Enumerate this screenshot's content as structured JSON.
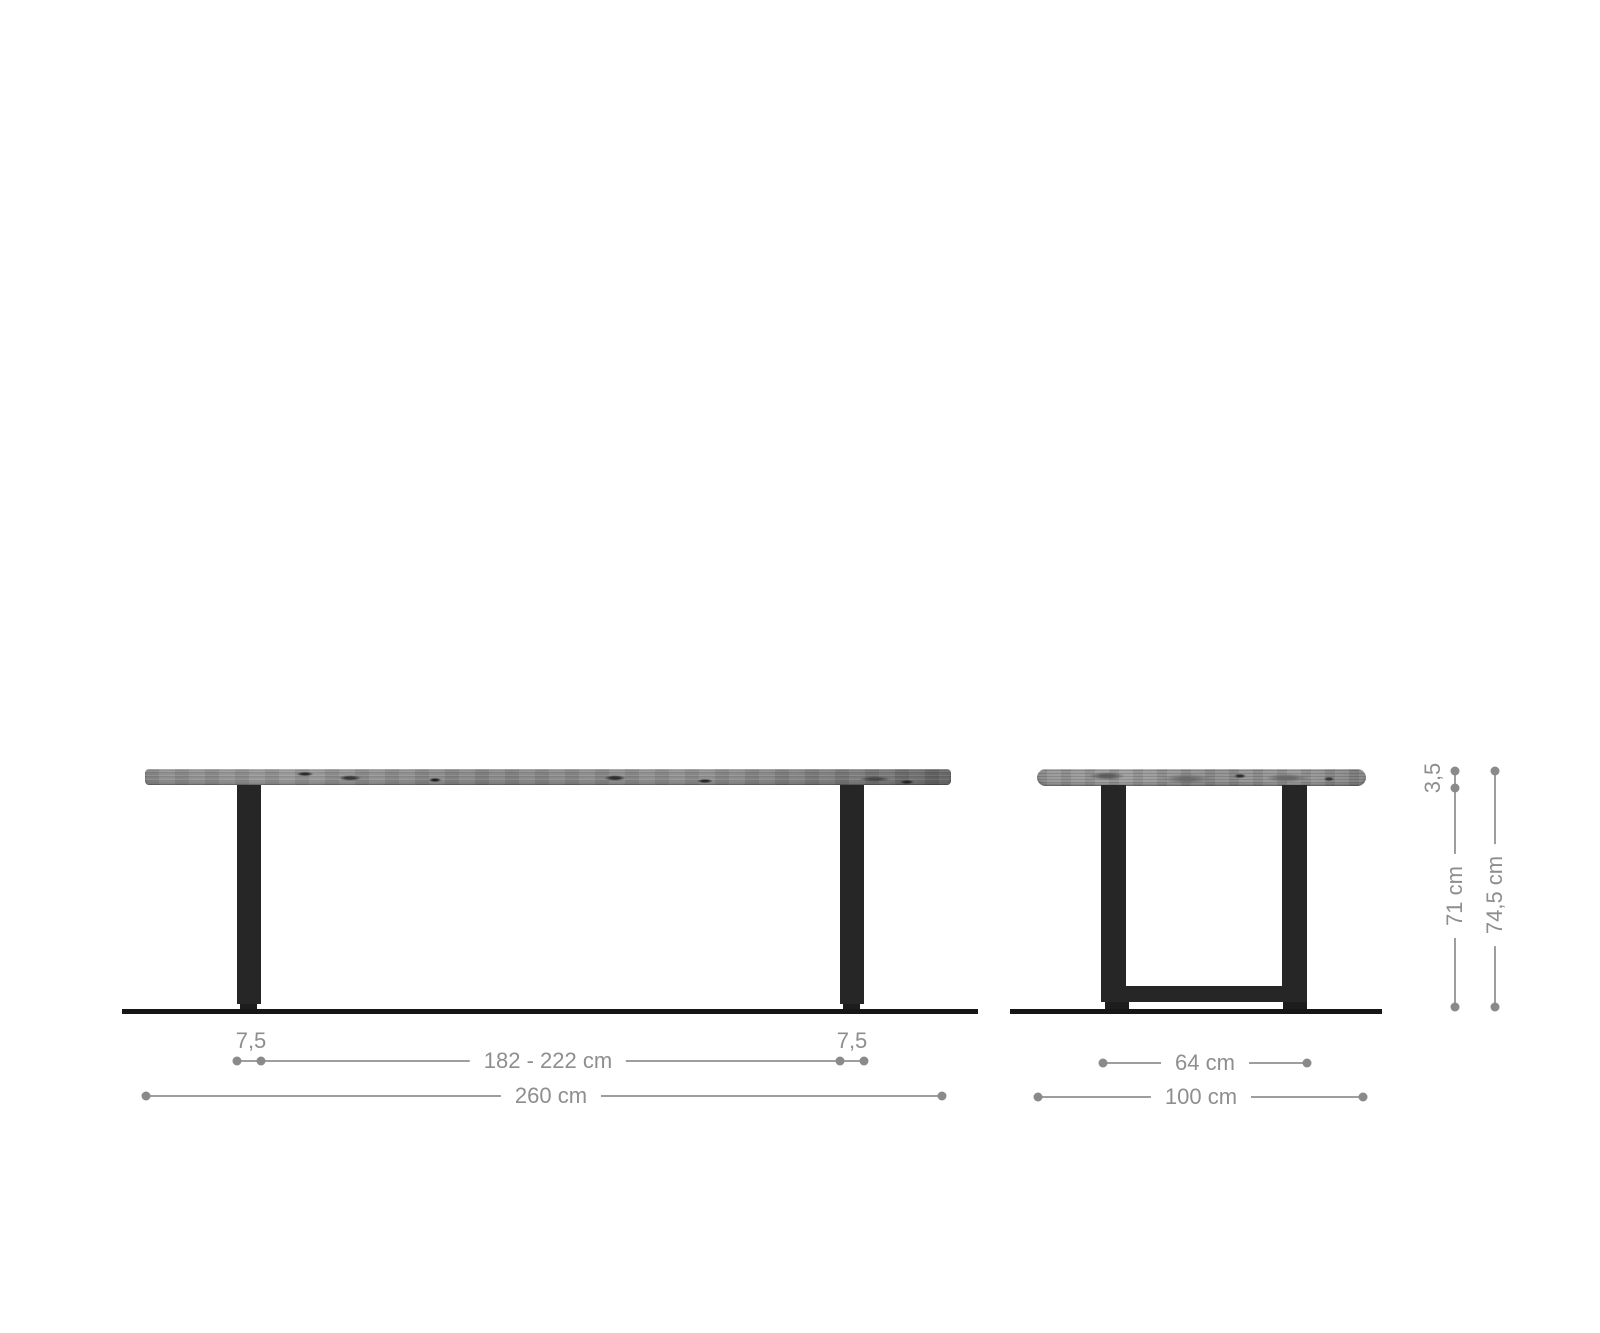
{
  "diagram": {
    "front_view": {
      "leg_inset_left_label": "7,5",
      "leg_inset_right_label": "7,5",
      "inner_span_label": "182 - 222 cm",
      "total_width_label": "260 cm"
    },
    "side_view": {
      "frame_width_label": "64 cm",
      "total_depth_label": "100 cm",
      "top_thickness_label": "3,5",
      "frame_height_label": "71 cm",
      "total_height_label": "74,5 cm"
    }
  },
  "colors": {
    "background": "#ffffff",
    "dimension_line": "#9e9e9e",
    "dimension_dot": "#8a8a8a",
    "dimension_text": "#8e8e8e",
    "leg_metal": "#262626",
    "floor_line": "#161616",
    "wood_base": "#8d8d8d"
  }
}
